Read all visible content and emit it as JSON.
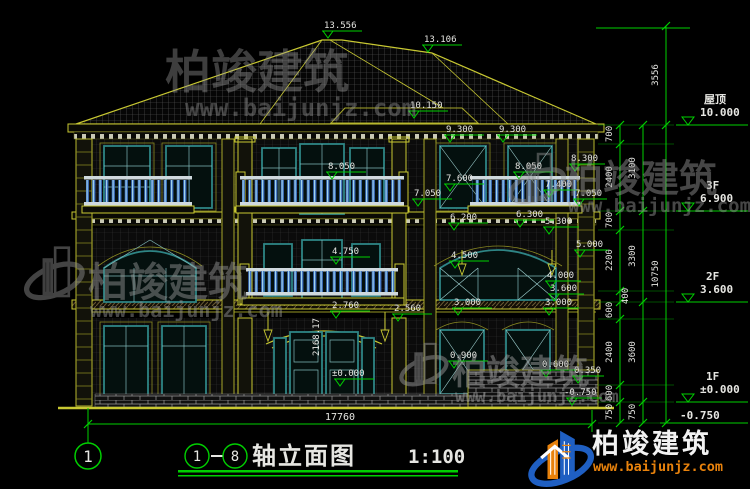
{
  "title_block": {
    "axis_start": "1",
    "axis_end": "8",
    "title": "轴立面图",
    "scale": "1:100"
  },
  "axis_bubble": "1",
  "bottom_dim": "17760",
  "levels": [
    {
      "name": "屋顶",
      "value": "10.000"
    },
    {
      "name": "3F",
      "value": "6.900"
    },
    {
      "name": "2F",
      "value": "3.600"
    },
    {
      "name": "1F",
      "value": "±0.000"
    },
    {
      "name": "",
      "value": "-0.750"
    }
  ],
  "chain_inner": [
    "700",
    "2400",
    "700",
    "2200",
    "400",
    "600",
    "2400",
    "600",
    "750"
  ],
  "chain_mid": [
    "3100",
    "3300",
    "3600",
    "750"
  ],
  "chain_outer": [
    "3556",
    "10750"
  ],
  "elev": [
    "13.556",
    "13.106",
    "10.150",
    "9.300",
    "9.300",
    "8.300",
    "8.050",
    "8.050",
    "7.600",
    "7.400",
    "7.050",
    "7.050",
    "6.200",
    "6.300",
    "5.300",
    "5.000",
    "4.750",
    "4.500",
    "4.000",
    "3.600",
    "3.000",
    "3.000",
    "2.760",
    "2.560",
    "0.900",
    "0.600",
    "0.350",
    "±0.000",
    "-0.750"
  ],
  "arc_note": "2168.17",
  "watermark": {
    "brand": "柏竣建筑",
    "url": "www.baijunjz.com"
  },
  "logo": {
    "brand": "柏竣建筑",
    "url": "www.baijunjz.com"
  },
  "colors": {
    "background": "#000000",
    "line_yellow": "#c8c832",
    "dim_green": "#00cf00",
    "frame_teal": "#2e8585",
    "baluster_blue": "#3d6fc0",
    "text": "#e6e6e2",
    "logo_blue": "#1f5fc2",
    "logo_orange": "#e8820c"
  }
}
